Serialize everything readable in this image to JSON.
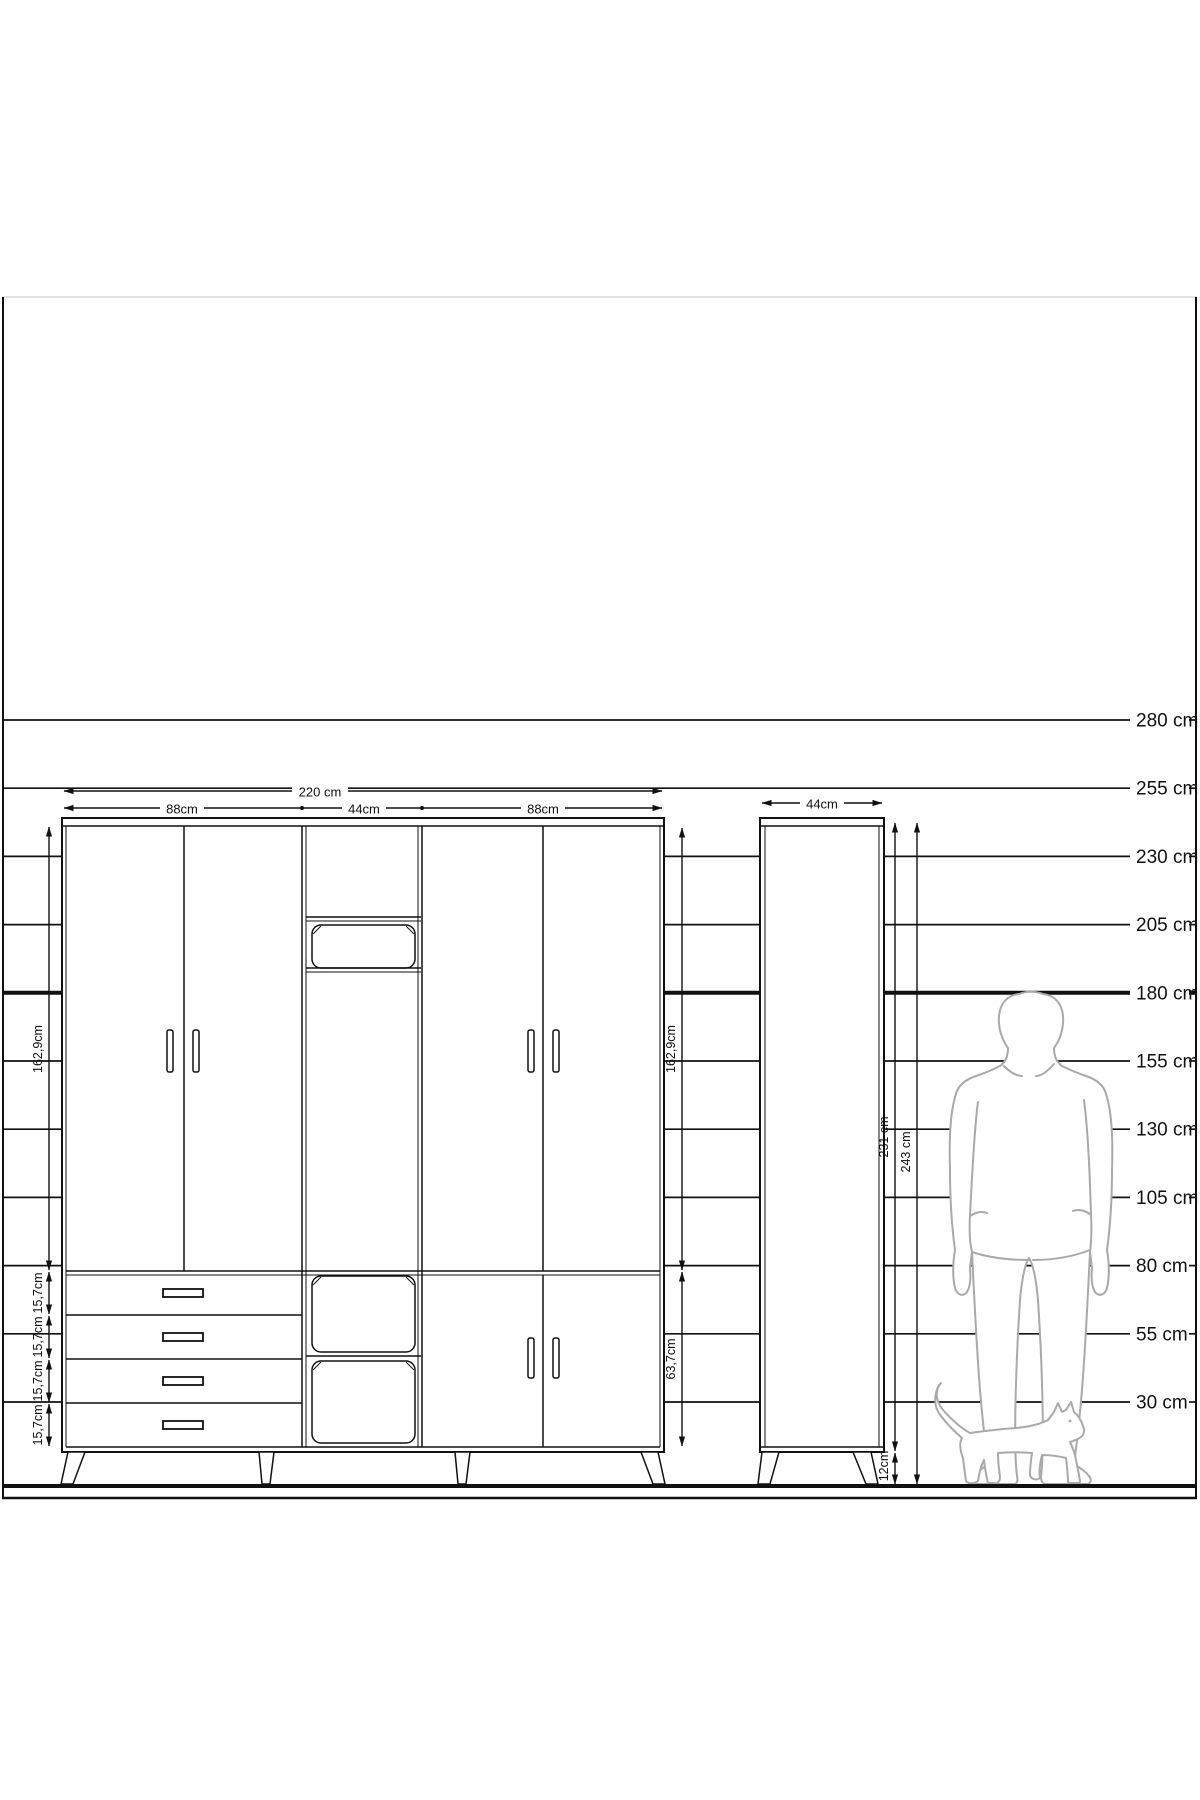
{
  "title": "wardrobe-technical-drawing",
  "scale_ruler": {
    "unit": "cm",
    "labels": [
      "280 cm",
      "255 cm",
      "230 cm",
      "205 cm",
      "180 cm",
      "155 cm",
      "130 cm",
      "105 cm",
      "80 cm",
      "55 cm",
      "30 cm"
    ],
    "emphasized": "180 cm"
  },
  "wardrobe": {
    "total_width_label": "220 cm",
    "section_width_labels": [
      "88cm",
      "44cm",
      "88cm"
    ],
    "left_door_height_label": "162,9cm",
    "right_door_height_label": "162,9cm",
    "drawer_height_labels": [
      "15,7cm",
      "15,7cm",
      "15,7cm",
      "15,7cm"
    ],
    "lower_right_door_height_label": "63,7cm"
  },
  "side_cabinet": {
    "width_label": "44cm",
    "body_height_label": "231 cm",
    "total_height_label": "243 cm",
    "leg_height_label": "12cm"
  },
  "figures": {
    "man": "man-silhouette",
    "cat": "cat-silhouette"
  },
  "colors": {
    "line": "#111111",
    "figure_outline": "#a9a9a9",
    "frame_top": "#d8d8d8",
    "background": "#ffffff"
  }
}
